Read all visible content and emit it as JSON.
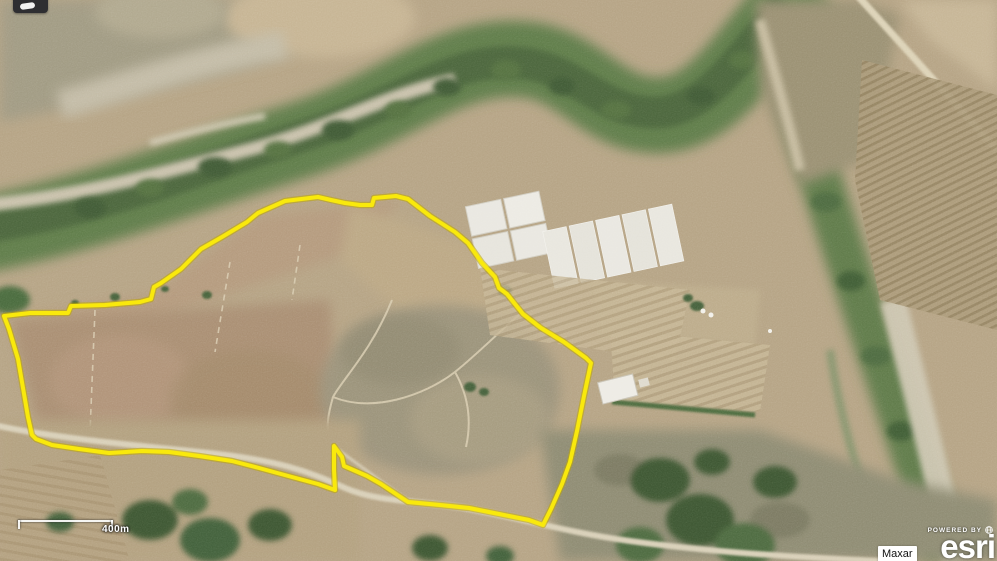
{
  "map": {
    "scale_bar": {
      "label": "400m"
    },
    "attribution": {
      "provider_label": "Maxar",
      "powered_by_label": "POWERED BY",
      "brand": "esri"
    },
    "icons": {
      "powered_by_globe": "globe-icon",
      "partial_tool": "tool-glyph-partial"
    },
    "overlay": {
      "parcel_outline_color": "#f9e90c",
      "parcel_outline_undercolor": "#bfa700",
      "parcel_polygon_points": "4,316 30,313 68,313 71,306 105,305 140,302 151,299 154,287 161,283 181,269 201,249 222,237 247,222 253,217 258,213 285,201 318,197 331,200 345,203 360,205 372,205 374,198 396,196 408,199 430,216 455,232 468,243 482,263 495,277 499,288 507,294 523,314 541,328 564,342 586,358 591,363 584,396 577,431 570,462 562,484 551,509 543,525 529,520 499,514 469,508 440,505 408,502 390,490 381,484 367,476 351,469 344,466 342,457 334,446 334,469 335,490 318,484 292,477 259,468 232,461 199,456 169,452 142,451 109,453 79,449 52,445 36,439 32,435 28,417 23,388 18,359 9,329"
    }
  }
}
